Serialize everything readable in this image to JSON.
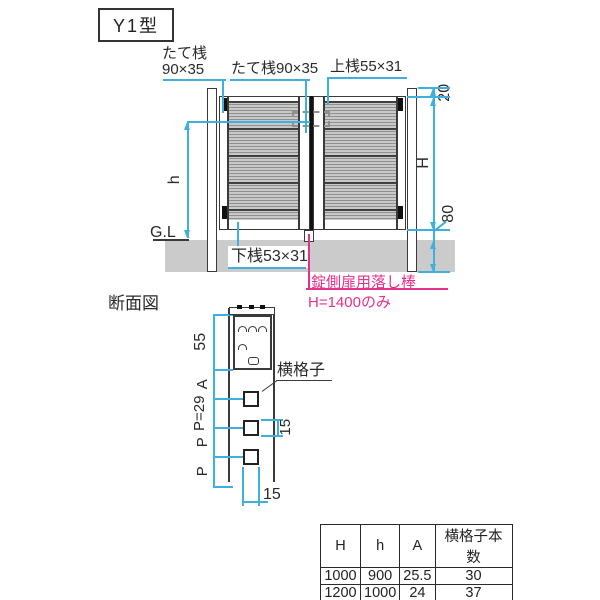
{
  "title": "Y1型",
  "colors": {
    "dimension_line": "#3fb0de",
    "note_pink": "#e6318c",
    "drawing_ink": "#3a3a3a",
    "ground_fill": "#cbcbcb"
  },
  "elevation": {
    "labels": {
      "stile_line1": "たて桟",
      "stile_line2": "90×35",
      "center_stile": "たて桟90×35",
      "top_rail": "上桟55×31",
      "bottom_rail": "下桟53×31",
      "ground_level": "G.L"
    },
    "dims": {
      "top_offset": "20",
      "gate_height": "H",
      "inner_height": "h",
      "bottom_clearance": "80",
      "post_embedment": "300"
    },
    "note": {
      "line1": "錠側扉用落し棒",
      "line2": "H=1400のみ"
    }
  },
  "section": {
    "title": "断面図",
    "labels": {
      "lattice": "横格子"
    },
    "dims": {
      "rail_height": "55",
      "a": "A",
      "pitch": "P=29",
      "p2": "P",
      "p3": "P",
      "lattice_height": "15",
      "lattice_width": "15"
    }
  },
  "spec_table": {
    "headers": [
      "H",
      "h",
      "A",
      "横格子本数"
    ],
    "rows": [
      [
        "1000",
        "900",
        "25.5",
        "30"
      ],
      [
        "1200",
        "1000",
        "24",
        "37"
      ],
      [
        "1400",
        "1000",
        "22.5",
        "44"
      ]
    ]
  }
}
